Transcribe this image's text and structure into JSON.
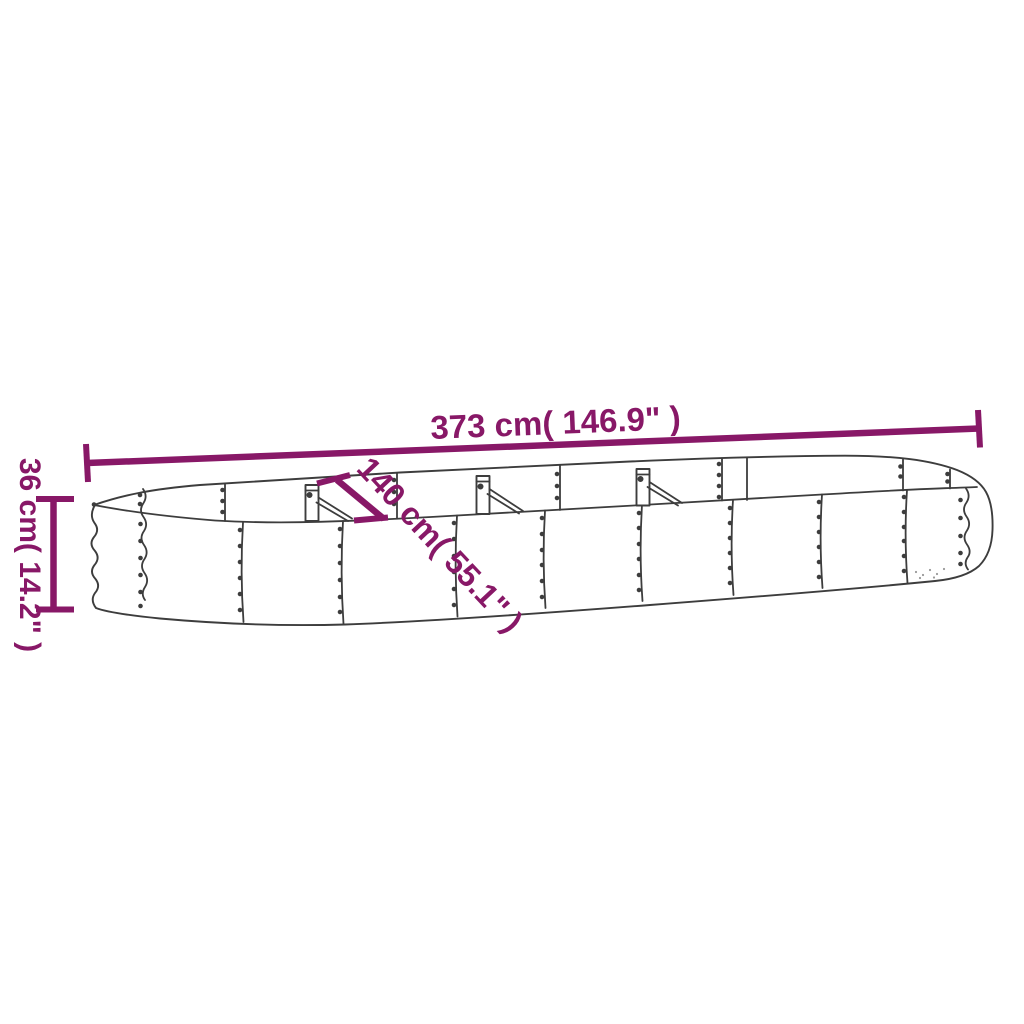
{
  "diagram": {
    "subject": "oval steel raised garden bed — perspective line drawing with dimensions",
    "colors": {
      "background": "#ffffff",
      "accent": "#881867",
      "line": "#3d3d3d"
    },
    "dimensions": {
      "length": {
        "label": "373 cm( 146.9\" )",
        "cm": 373,
        "inches": 146.9
      },
      "width": {
        "label": "140 cm( 55.1\" )",
        "cm": 140,
        "inches": 55.1
      },
      "height": {
        "label": "36 cm( 14.2\" )",
        "cm": 36,
        "inches": 14.2
      }
    }
  }
}
